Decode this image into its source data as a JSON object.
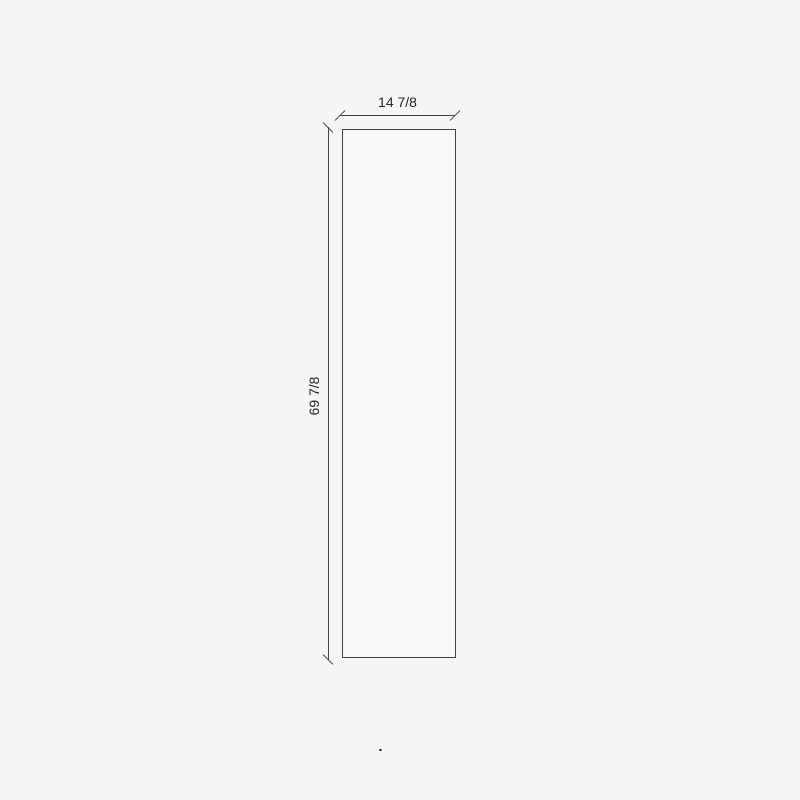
{
  "drawing": {
    "width_dimension_label": "14 7/8",
    "height_dimension_label": "69 7/8"
  },
  "colors": {
    "background": "#f5f5f5",
    "panel_fill": "#f8f8f8",
    "line": "#424242",
    "text": "#262626"
  }
}
